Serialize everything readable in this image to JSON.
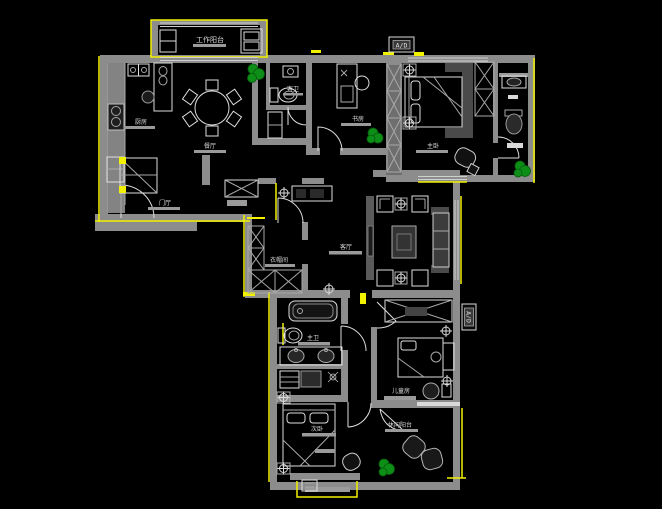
{
  "canvas": {
    "background": "#000000",
    "width": 662,
    "height": 509
  },
  "palette": {
    "wall": "#8c8c8c",
    "wall_dark": "#6e6e6e",
    "furniture_line": "#dedede",
    "accent": "#f2f200",
    "plant": "#0d8f17",
    "plant_dark": "#065c0d",
    "label": "#dcdcdc",
    "dark_fill": "#2a2a2a"
  },
  "rooms": [
    {
      "id": "work-balcony",
      "label": "工作阳台"
    },
    {
      "id": "kitchen",
      "label": "厨房"
    },
    {
      "id": "dining",
      "label": "餐厅"
    },
    {
      "id": "foyer",
      "label": "门厅"
    },
    {
      "id": "guest-bath",
      "label": "客卫"
    },
    {
      "id": "study",
      "label": "书房"
    },
    {
      "id": "master-bedroom",
      "label": "主卧"
    },
    {
      "id": "living",
      "label": "客厅"
    },
    {
      "id": "closet",
      "label": "衣帽间"
    },
    {
      "id": "master-bath",
      "label": "主卫"
    },
    {
      "id": "second-bedroom",
      "label": "次卧"
    },
    {
      "id": "kids-room",
      "label": "儿童房"
    },
    {
      "id": "leisure-balcony",
      "label": "休闲阳台"
    }
  ],
  "markers": {
    "top": "A/D",
    "right": "A/D"
  }
}
